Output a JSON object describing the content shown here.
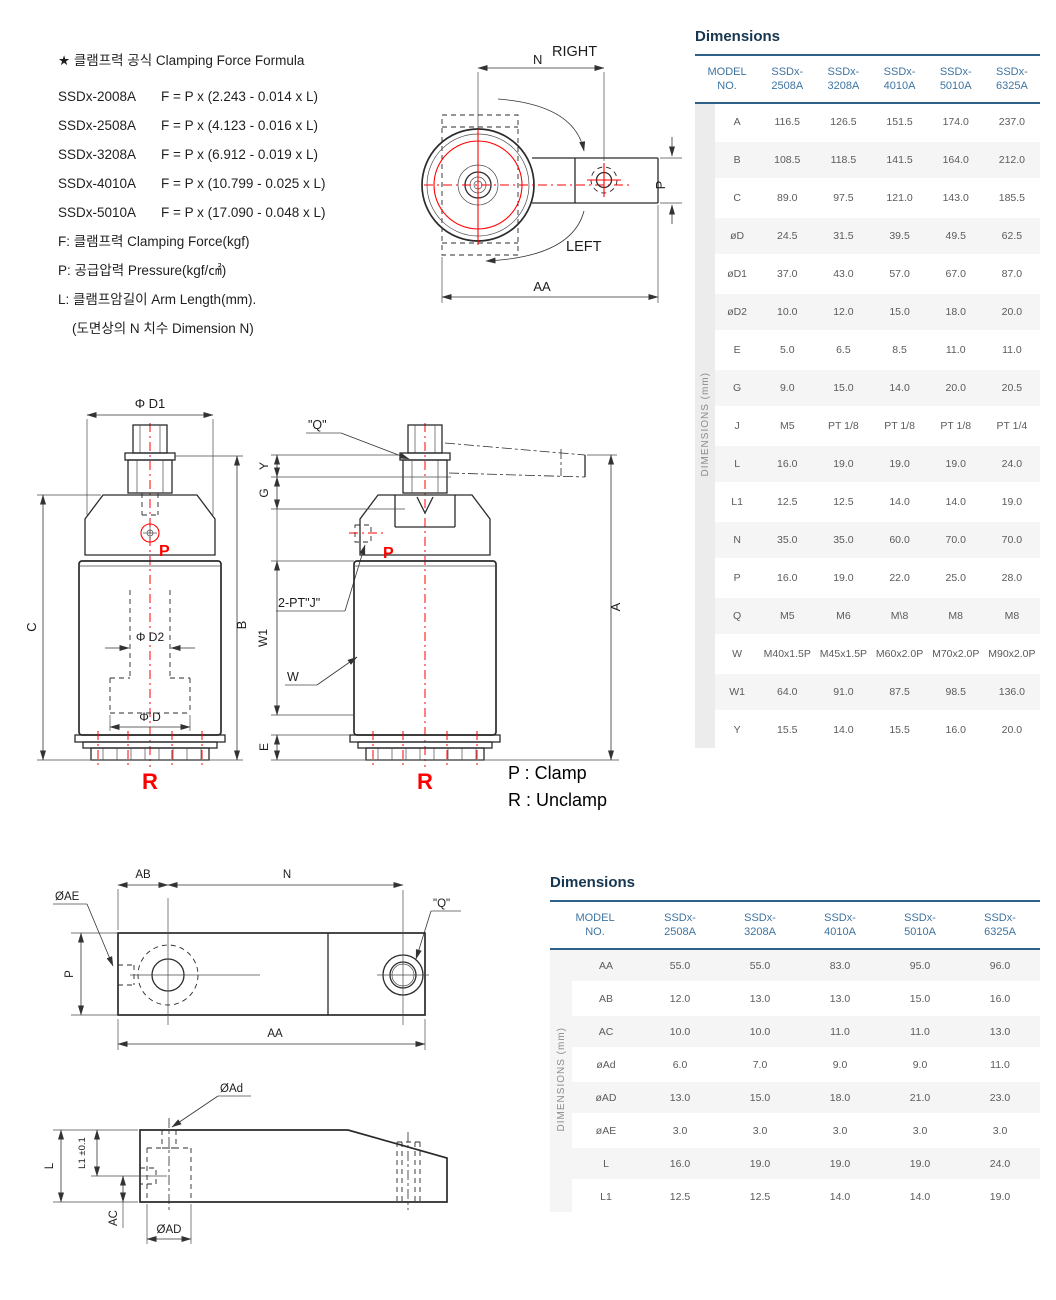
{
  "colors": {
    "accent_blue_text": "#3f74a0",
    "accent_blue_line": "#2e6189",
    "title_navy": "#17364f",
    "red": "#ff0000",
    "row_stripe": "#f5f5f5",
    "side_strip": "#ececec",
    "body_text": "#5a5b5d"
  },
  "formula_block": {
    "title": "★ 클램프력 공식 Clamping Force Formula",
    "formulas": [
      {
        "model": "SSDx-2008A",
        "formula": "F = P x (2.243 - 0.014 x L)"
      },
      {
        "model": "SSDx-2508A",
        "formula": "F = P x (4.123 - 0.016 x L)"
      },
      {
        "model": "SSDx-3208A",
        "formula": "F = P x (6.912 - 0.019 x L)"
      },
      {
        "model": "SSDx-4010A",
        "formula": "F = P x (10.799 - 0.025 x L)"
      },
      {
        "model": "SSDx-5010A",
        "formula": "F = P x (17.090 - 0.048 x L)"
      }
    ],
    "notes": [
      "F: 클램프력 Clamping Force(kgf)",
      "P: 공급압력 Pressure(kgf/㎠)",
      "L: 클램프암길이 Arm Length(mm).",
      "(도면상의 N 치수  Dimension N)"
    ]
  },
  "legend": {
    "p": "P : Clamp",
    "r": "R : Unclamp"
  },
  "drawings": {
    "top_view": {
      "right": "RIGHT",
      "left": "LEFT",
      "n": "N",
      "aa": "AA",
      "p": "P"
    },
    "front_left": {
      "d1": "Φ D1",
      "c": "C",
      "b": "B",
      "d2": "Φ D2",
      "d": "Φ D",
      "p": "P",
      "r": "R"
    },
    "front_right": {
      "q": "\"Q\"",
      "port": "2-PT\"J\"",
      "w": "W",
      "w1": "W1",
      "y": "Y",
      "g": "G",
      "e": "E",
      "a": "A",
      "p": "P",
      "r": "R"
    },
    "arm_top": {
      "ab": "AB",
      "n": "N",
      "ae": "ØAE",
      "q": "\"Q\"",
      "p": "P",
      "aa": "AA"
    },
    "arm_side": {
      "ad_small": "ØAd",
      "l": "L",
      "l1": "L1 ±0.1",
      "ac": "AC",
      "ad": "ØAD"
    }
  },
  "table1": {
    "title": "Dimensions",
    "col_header": "MODEL NO.",
    "side_label": "DIMENSIONS (mm)",
    "models": [
      "SSDx-2508A",
      "SSDx-3208A",
      "SSDx-4010A",
      "SSDx-5010A",
      "SSDx-6325A"
    ],
    "rows": [
      {
        "label": "A",
        "values": [
          "116.5",
          "126.5",
          "151.5",
          "174.0",
          "237.0"
        ]
      },
      {
        "label": "B",
        "values": [
          "108.5",
          "118.5",
          "141.5",
          "164.0",
          "212.0"
        ]
      },
      {
        "label": "C",
        "values": [
          "89.0",
          "97.5",
          "121.0",
          "143.0",
          "185.5"
        ]
      },
      {
        "label": "øD",
        "values": [
          "24.5",
          "31.5",
          "39.5",
          "49.5",
          "62.5"
        ]
      },
      {
        "label": "øD1",
        "values": [
          "37.0",
          "43.0",
          "57.0",
          "67.0",
          "87.0"
        ]
      },
      {
        "label": "øD2",
        "values": [
          "10.0",
          "12.0",
          "15.0",
          "18.0",
          "20.0"
        ]
      },
      {
        "label": "E",
        "values": [
          "5.0",
          "6.5",
          "8.5",
          "11.0",
          "11.0"
        ]
      },
      {
        "label": "G",
        "values": [
          "9.0",
          "15.0",
          "14.0",
          "20.0",
          "20.5"
        ]
      },
      {
        "label": "J",
        "values": [
          "M5",
          "PT 1/8",
          "PT 1/8",
          "PT 1/8",
          "PT 1/4"
        ]
      },
      {
        "label": "L",
        "values": [
          "16.0",
          "19.0",
          "19.0",
          "19.0",
          "24.0"
        ]
      },
      {
        "label": "L1",
        "values": [
          "12.5",
          "12.5",
          "14.0",
          "14.0",
          "19.0"
        ]
      },
      {
        "label": "N",
        "values": [
          "35.0",
          "35.0",
          "60.0",
          "70.0",
          "70.0"
        ]
      },
      {
        "label": "P",
        "values": [
          "16.0",
          "19.0",
          "22.0",
          "25.0",
          "28.0"
        ]
      },
      {
        "label": "Q",
        "values": [
          "M5",
          "M6",
          "M\\8",
          "M8",
          "M8"
        ]
      },
      {
        "label": "W",
        "values": [
          "M40x1.5P",
          "M45x1.5P",
          "M60x2.0P",
          "M70x2.0P",
          "M90x2.0P"
        ]
      },
      {
        "label": "W1",
        "values": [
          "64.0",
          "91.0",
          "87.5",
          "98.5",
          "136.0"
        ]
      },
      {
        "label": "Y",
        "values": [
          "15.5",
          "14.0",
          "15.5",
          "16.0",
          "20.0"
        ]
      }
    ]
  },
  "table2": {
    "title": "Dimensions",
    "col_header": "MODEL NO.",
    "side_label": "DIMENSIONS (mm)",
    "models": [
      "SSDx-2508A",
      "SSDx-3208A",
      "SSDx-4010A",
      "SSDx-5010A",
      "SSDx-6325A"
    ],
    "rows": [
      {
        "label": "AA",
        "values": [
          "55.0",
          "55.0",
          "83.0",
          "95.0",
          "96.0"
        ]
      },
      {
        "label": "AB",
        "values": [
          "12.0",
          "13.0",
          "13.0",
          "15.0",
          "16.0"
        ]
      },
      {
        "label": "AC",
        "values": [
          "10.0",
          "10.0",
          "11.0",
          "11.0",
          "13.0"
        ]
      },
      {
        "label": "øAd",
        "values": [
          "6.0",
          "7.0",
          "9.0",
          "9.0",
          "11.0"
        ]
      },
      {
        "label": "øAD",
        "values": [
          "13.0",
          "15.0",
          "18.0",
          "21.0",
          "23.0"
        ]
      },
      {
        "label": "øAE",
        "values": [
          "3.0",
          "3.0",
          "3.0",
          "3.0",
          "3.0"
        ]
      },
      {
        "label": "L",
        "values": [
          "16.0",
          "19.0",
          "19.0",
          "19.0",
          "24.0"
        ]
      },
      {
        "label": "L1",
        "values": [
          "12.5",
          "12.5",
          "14.0",
          "14.0",
          "19.0"
        ]
      }
    ]
  }
}
